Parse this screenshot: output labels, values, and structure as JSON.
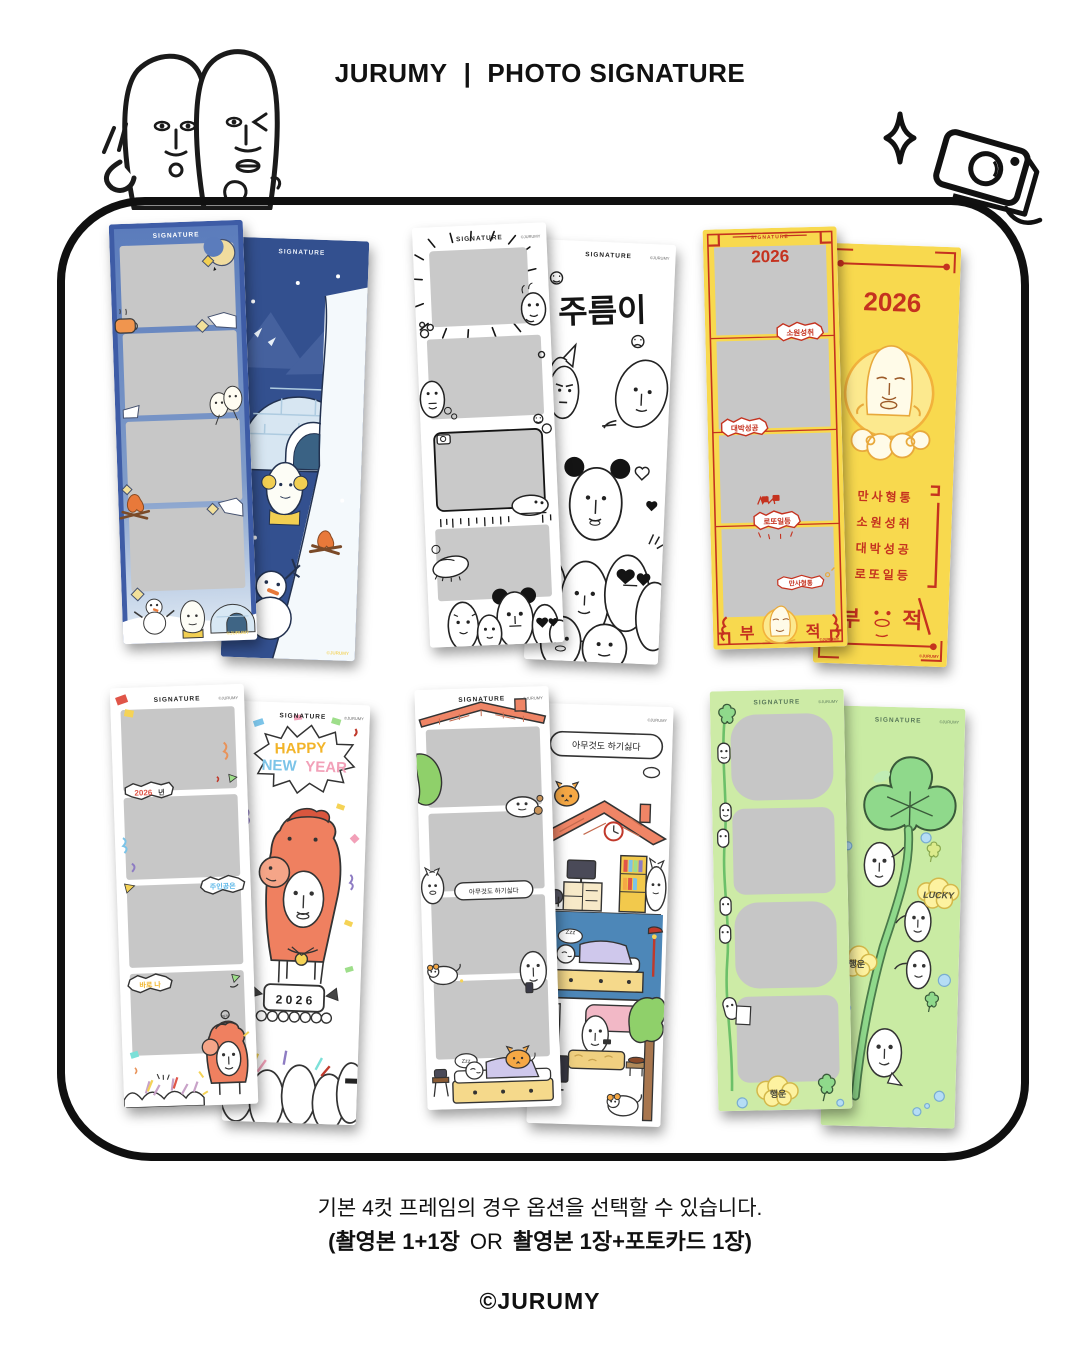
{
  "header": {
    "brand": "JURUMY",
    "divider": "|",
    "subtitle": "PHOTO SIGNATURE"
  },
  "strip": {
    "signature": "SIGNATURE",
    "copyright": "©JURUMY"
  },
  "designs": {
    "winter": {
      "name": "winter-igloo"
    },
    "jureumi": {
      "title": "주름이"
    },
    "talisman": {
      "year": "2026",
      "bubble_wish": "소원성취",
      "bubble_success": "대박성공",
      "bubble_lotto": "로또일등",
      "bubble_all": "만사형통",
      "scroll_lines": [
        "만사형통",
        "소원성취",
        "대박성공",
        "로또일등"
      ],
      "bu": "부",
      "jeok": "적"
    },
    "newyear": {
      "happy": "HAPPY",
      "new": "NEW",
      "year_word": "YEAR",
      "bubble_year_num": "2026",
      "bubble_year_suffix": "년",
      "bubble_main": "주인공은",
      "bubble_me": "바로 나",
      "podium_year": "2 0 2 6",
      "horse_sound": "따각"
    },
    "house": {
      "bubble": "아무것도 하기싫다",
      "zzz": "Zzz"
    },
    "lucky": {
      "lucky_en": "LUCKY",
      "luck_ko": "행운"
    }
  },
  "footer": {
    "line1": "기본 4컷 프레임의 경우 옵션을 선택할 수 있습니다.",
    "line2_open": "(",
    "line2_bold1": "촬영본 1+1장",
    "line2_or": "OR",
    "line2_bold2": "촬영본 1장+포토카드 1장",
    "line2_close": ")",
    "copyright": "©JURUMY"
  },
  "colors": {
    "winter_blue": "#3e5ca6",
    "winter_sky": "#33508f",
    "talisman_yellow": "#f8d94e",
    "talisman_red": "#c5321f",
    "lucky_green_light": "#cdeba6",
    "lucky_green": "#8fd98b",
    "horse_orange": "#ef8060",
    "placeholder_gray": "#c7c7c7"
  }
}
